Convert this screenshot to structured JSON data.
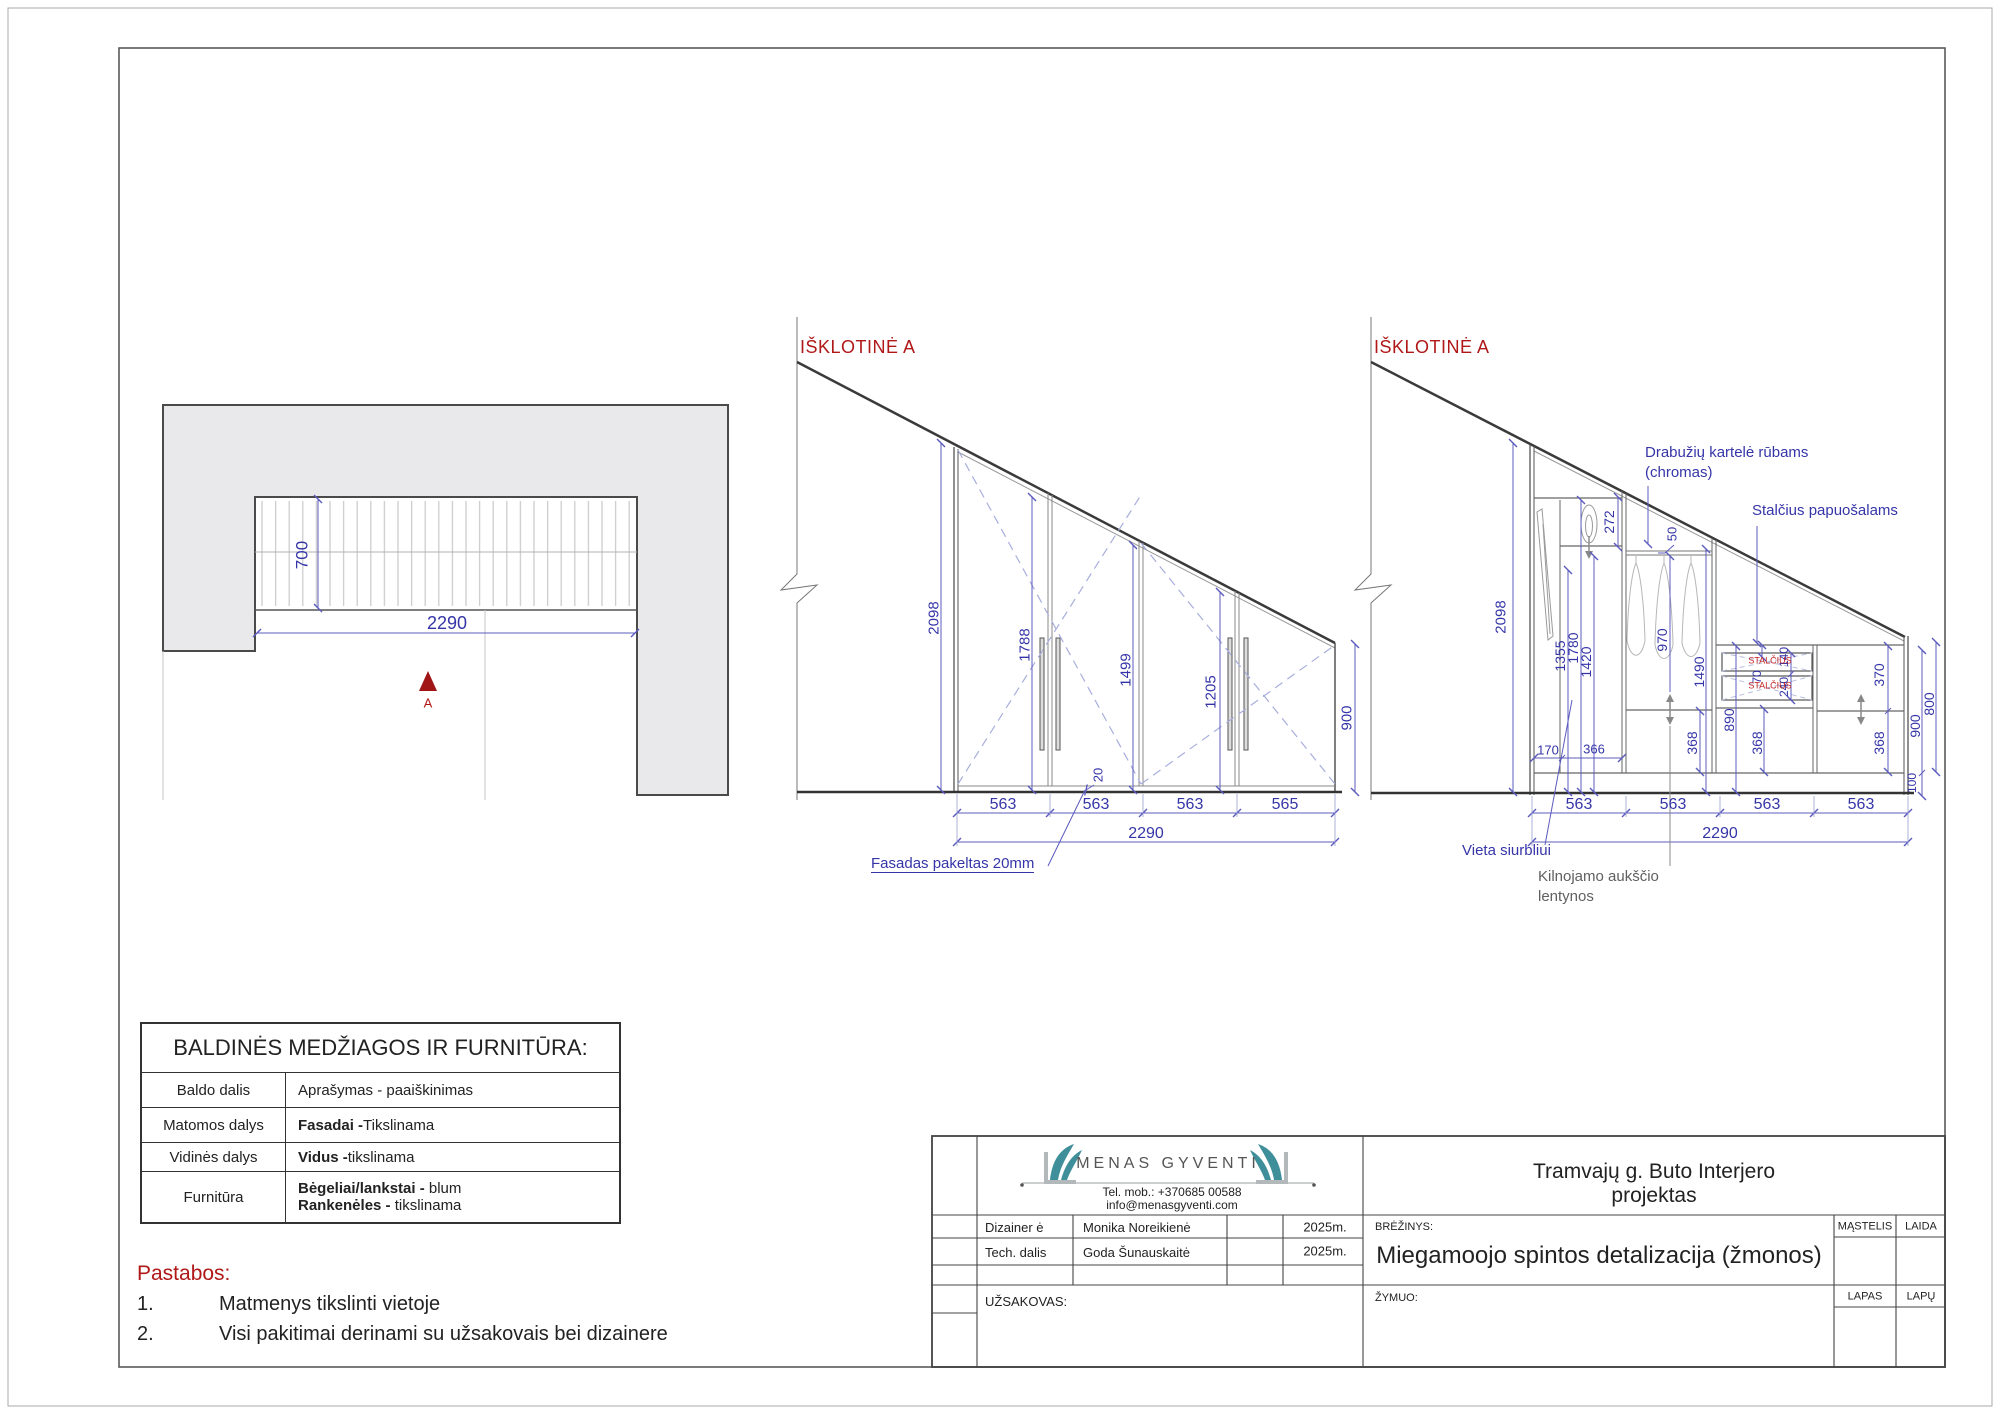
{
  "palette": {
    "dim_text": "#3535a8",
    "dim_line": "#5b5bbd",
    "wall_fill": "#e9e9eb",
    "wall_line": "#4a4a4a",
    "accent_red": "#b01818",
    "drawer_red": "#c42222",
    "logo_teal": "#3f8f9b",
    "gray_note": "#606060"
  },
  "plan": {
    "section_marker": "A"
  },
  "mid": {
    "title": "IŠKLOTINĖ A"
  },
  "right": {
    "title": "IŠKLOTINĖ A"
  },
  "labels": {
    "plan": [
      {
        "t": "700",
        "x": 302,
        "y": 555,
        "r": 1,
        "s": 17
      },
      {
        "t": "2290",
        "x": 447,
        "y": 623,
        "s": 18
      },
      {
        "t": "A",
        "x": 428,
        "y": 703,
        "s": 13,
        "c": "#b01818"
      }
    ],
    "mid": [
      {
        "t": "2098",
        "x": 934,
        "y": 618,
        "r": 1,
        "s": 15
      },
      {
        "t": "1788",
        "x": 1025,
        "y": 645,
        "r": 1,
        "s": 15
      },
      {
        "t": "1499",
        "x": 1126,
        "y": 670,
        "r": 1,
        "s": 15
      },
      {
        "t": "1205",
        "x": 1211,
        "y": 692,
        "r": 1,
        "s": 15
      },
      {
        "t": "900",
        "x": 1347,
        "y": 718,
        "r": 1,
        "s": 15
      },
      {
        "t": "20",
        "x": 1098,
        "y": 775,
        "r": 1,
        "s": 13
      },
      {
        "t": "563",
        "x": 1003,
        "y": 805,
        "s": 16
      },
      {
        "t": "563",
        "x": 1096,
        "y": 805,
        "s": 16
      },
      {
        "t": "563",
        "x": 1190,
        "y": 805,
        "s": 16
      },
      {
        "t": "565",
        "x": 1285,
        "y": 805,
        "s": 16
      },
      {
        "t": "2290",
        "x": 1146,
        "y": 834,
        "s": 16
      }
    ],
    "right": [
      {
        "t": "2098",
        "x": 1501,
        "y": 617,
        "r": 1,
        "s": 15
      },
      {
        "t": "1355",
        "x": 1560,
        "y": 656,
        "r": 1,
        "s": 14
      },
      {
        "t": "1780",
        "x": 1573,
        "y": 648,
        "r": 1,
        "s": 14
      },
      {
        "t": "1420",
        "x": 1586,
        "y": 662,
        "r": 1,
        "s": 14
      },
      {
        "t": "272",
        "x": 1609,
        "y": 522,
        "r": 1,
        "s": 14
      },
      {
        "t": "50",
        "x": 1672,
        "y": 534,
        "r": 1,
        "s": 13
      },
      {
        "t": "970",
        "x": 1662,
        "y": 640,
        "r": 1,
        "s": 14
      },
      {
        "t": "1490",
        "x": 1699,
        "y": 672,
        "r": 1,
        "s": 14
      },
      {
        "t": "890",
        "x": 1729,
        "y": 720,
        "r": 1,
        "s": 14
      },
      {
        "t": "368",
        "x": 1692,
        "y": 743,
        "r": 1,
        "s": 14
      },
      {
        "t": "368",
        "x": 1757,
        "y": 743,
        "r": 1,
        "s": 14
      },
      {
        "t": "368",
        "x": 1879,
        "y": 743,
        "r": 1,
        "s": 14
      },
      {
        "t": "70",
        "x": 1757,
        "y": 677,
        "r": 1,
        "s": 12
      },
      {
        "t": "140",
        "x": 1784,
        "y": 657,
        "r": 1,
        "s": 12
      },
      {
        "t": "240",
        "x": 1784,
        "y": 687,
        "r": 1,
        "s": 12
      },
      {
        "t": "370",
        "x": 1879,
        "y": 675,
        "r": 1,
        "s": 14
      },
      {
        "t": "900",
        "x": 1915,
        "y": 726,
        "r": 1,
        "s": 14
      },
      {
        "t": "800",
        "x": 1929,
        "y": 704,
        "r": 1,
        "s": 14
      },
      {
        "t": "100",
        "x": 1912,
        "y": 783,
        "r": 1,
        "s": 12
      },
      {
        "t": "170",
        "x": 1548,
        "y": 750,
        "s": 13
      },
      {
        "t": "366",
        "x": 1594,
        "y": 749,
        "s": 13
      },
      {
        "t": "STALČIUS",
        "x": 1770,
        "y": 661,
        "s": 9,
        "c": "#c42222"
      },
      {
        "t": "STALČIUS",
        "x": 1770,
        "y": 686,
        "s": 9,
        "c": "#c42222"
      },
      {
        "t": "563",
        "x": 1579,
        "y": 805,
        "s": 16
      },
      {
        "t": "563",
        "x": 1673,
        "y": 805,
        "s": 16
      },
      {
        "t": "563",
        "x": 1767,
        "y": 805,
        "s": 16
      },
      {
        "t": "563",
        "x": 1861,
        "y": 805,
        "s": 16
      },
      {
        "t": "2290",
        "x": 1720,
        "y": 834,
        "s": 16
      }
    ],
    "callouts": [
      {
        "t": "Fasadas pakeltas 20mm",
        "x": 871,
        "y": 856,
        "s": 15,
        "a": "l",
        "u": 1
      },
      {
        "t": "Drabužių kartelė rūbams",
        "x": 1645,
        "y": 445,
        "s": 15,
        "a": "l"
      },
      {
        "t": "(chromas)",
        "x": 1645,
        "y": 465,
        "s": 15,
        "a": "l"
      },
      {
        "t": "Stalčius papuošalams",
        "x": 1752,
        "y": 503,
        "s": 15,
        "a": "l"
      },
      {
        "t": "Vieta siurbliui",
        "x": 1462,
        "y": 843,
        "s": 15,
        "a": "l"
      },
      {
        "t": "Kilnojamo aukščio",
        "x": 1538,
        "y": 869,
        "s": 15,
        "a": "l",
        "c": "#606060"
      },
      {
        "t": "lentynos",
        "x": 1538,
        "y": 889,
        "s": 15,
        "a": "l",
        "c": "#606060"
      }
    ]
  },
  "materials_table": {
    "title": "BALDINĖS MEDŽIAGOS IR FURNITŪRA:",
    "header": {
      "col1": "Baldo dalis",
      "col2": "Aprašymas - paaiškinimas"
    },
    "rows": [
      {
        "part": "Matomos dalys",
        "b": "Fasadai -",
        "rest": " Tikslinama"
      },
      {
        "part": "Vidinės dalys",
        "b": "Vidus -",
        "rest": " tikslinama"
      },
      {
        "part": "Furnitūra",
        "b": "Bėgeliai/lankstai -",
        "rest": " blum",
        "b2": "Rankenėles -",
        "rest2": " tikslinama"
      }
    ]
  },
  "notes": {
    "heading": "Pastabos:",
    "items": [
      {
        "num": "1.",
        "text": "Matmenys tikslinti vietoje"
      },
      {
        "num": "2.",
        "text": "Visi pakitimai derinami su užsakovais bei dizainere"
      }
    ]
  },
  "title_block": {
    "logo_text": "MENAS GYVENTI",
    "tel": "Tel. mob.: +370685 00588",
    "email": "info@menasgyventi.com",
    "designer_label": "Dizainer ė",
    "designer_name": "Monika Noreikienė",
    "designer_year": "2025m.",
    "tech_label": "Tech. dalis",
    "tech_name": "Goda Šunauskaitė",
    "tech_year": "2025m.",
    "client_label": "UŽSAKOVAS:",
    "project_line1": "Tramvajų g. Buto Interjero",
    "project_line2": "projektas",
    "drawing_label": "BRĖŽINYS:",
    "drawing_title": "Miegamoojo spintos detalizacija (žmonos)",
    "scale_label": "MĄSTELIS",
    "issue_label": "LAIDA",
    "mark_label": "ŽYMUO:",
    "sheet_label": "LAPAS",
    "sheets_label": "LAPŲ"
  }
}
